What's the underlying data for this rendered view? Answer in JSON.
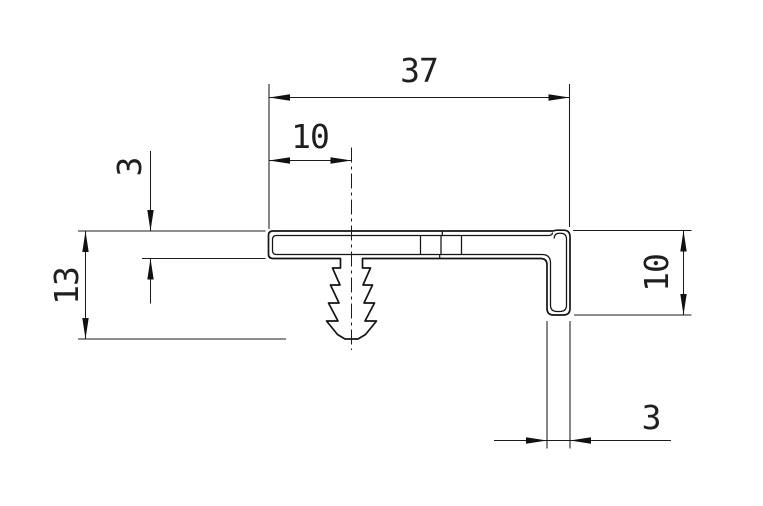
{
  "drawing": {
    "type": "technical-profile-cross-section",
    "units_shown": false,
    "colors": {
      "line": "#141414",
      "dimension": "#1c1c1c",
      "text": "#1f1f1f",
      "background": "#ffffff"
    },
    "features": {
      "top_flange": "flat bar profile",
      "barbed_leg": "christmas-tree snap-in anchor",
      "end_leg": "downturned end lip"
    }
  },
  "dimensions": {
    "overall_width": {
      "value": "37",
      "orientation": "horizontal"
    },
    "anchor_offset": {
      "value": "10",
      "orientation": "horizontal"
    },
    "flange_thickness": {
      "value": "3",
      "orientation": "vertical-rotated"
    },
    "overall_height": {
      "value": "13",
      "orientation": "vertical-rotated"
    },
    "end_leg_height": {
      "value": "10",
      "orientation": "vertical-rotated"
    },
    "end_leg_thickness": {
      "value": "3",
      "orientation": "horizontal"
    }
  }
}
